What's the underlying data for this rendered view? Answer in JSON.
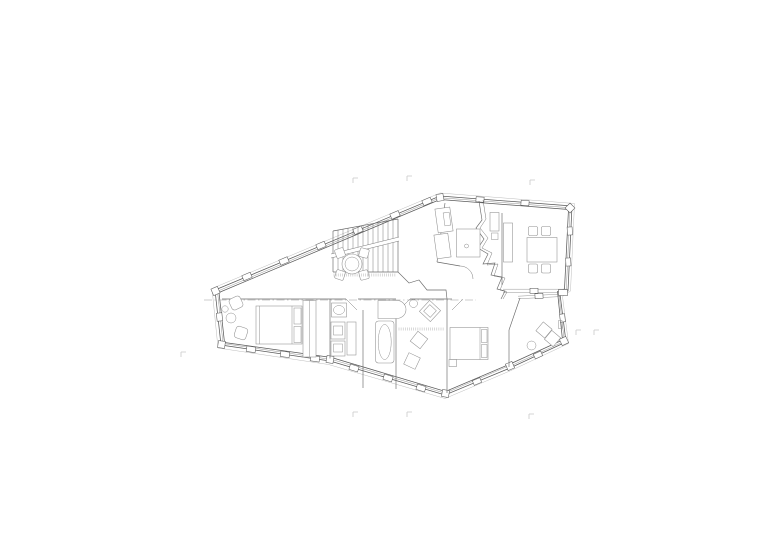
{
  "canvas": {
    "width": 780,
    "height": 551,
    "background_color": "#ffffff"
  },
  "drawing": {
    "kind": "architectural-floor-plan",
    "description": "Thin-line upper floor plan of an irregular polygonal house centered on a white sheet; no readable text, only faint section markers at the margins",
    "colors": {
      "wall": "#5a5a5a",
      "partition": "#6a6a6a",
      "furniture": "#8f8f8f",
      "window": "#7a7a7a",
      "eave": "#bcbcbc",
      "section_line": "#9a9a9a",
      "hatch": "#9c9c9c",
      "marker": "#c9c9c9"
    },
    "elements": [
      "glazed-facade-band",
      "staircase",
      "round-table-with-chairs",
      "dressing-bath-fixtures",
      "dining-table-with-chairs",
      "sideboard",
      "double-bed-west",
      "armchairs-and-side-table",
      "wardrobe",
      "wash-basin",
      "storage-cabinets",
      "curved-shower",
      "bathtub",
      "floor-cushions",
      "double-bed-east",
      "nightstand",
      "lounge-chair",
      "loggia-table",
      "jagged-core-wall",
      "section-dash-line"
    ],
    "stair": {
      "tread_count": 13
    },
    "hatch_strips": [
      {
        "x1": 334,
        "x2": 397,
        "y": 273.5,
        "h": 3
      },
      {
        "x1": 399,
        "x2": 444,
        "y": 327.5,
        "h": 3
      }
    ],
    "section_markers": [
      {
        "x": 353,
        "y": 178
      },
      {
        "x": 407,
        "y": 176
      },
      {
        "x": 530,
        "y": 180
      },
      {
        "x": 353,
        "y": 412
      },
      {
        "x": 407,
        "y": 412
      },
      {
        "x": 529,
        "y": 414
      },
      {
        "x": 181,
        "y": 352
      },
      {
        "x": 576,
        "y": 330
      },
      {
        "x": 594,
        "y": 330
      }
    ]
  }
}
